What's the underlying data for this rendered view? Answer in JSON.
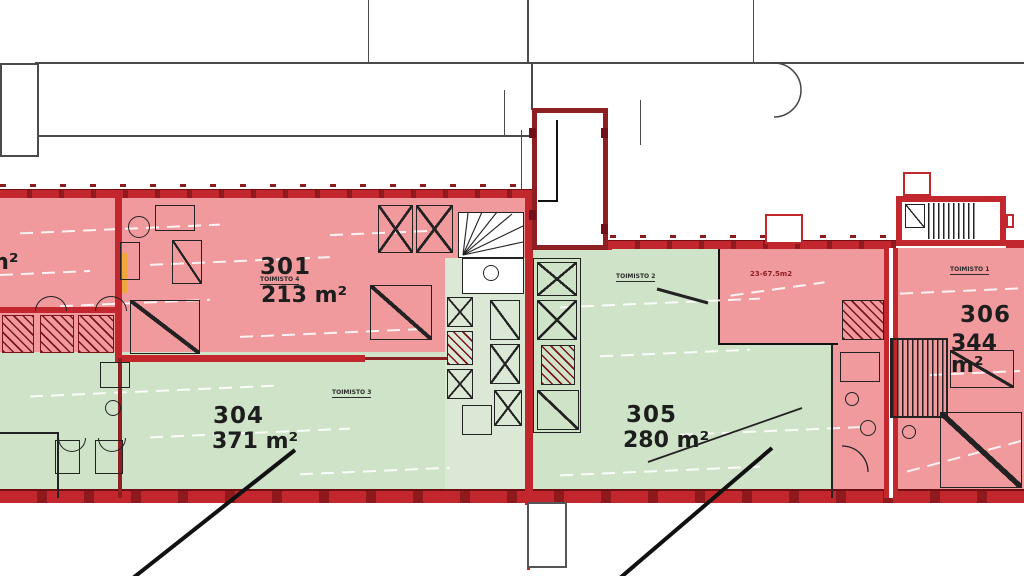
{
  "plan": {
    "kind": "architectural floor plan, office storey",
    "rooms": [
      {
        "number": "301",
        "area": "213 m²",
        "type_label": "TOIMISTO 4",
        "fill": "#f09a9d"
      },
      {
        "number": "304",
        "area": "371 m²",
        "type_label": "TOIMISTO 3",
        "fill": "#cfe3c8"
      },
      {
        "number": "305",
        "area": "280 m²",
        "type_label": "TOIMISTO 2",
        "fill": "#cfe3c8"
      },
      {
        "number": "306",
        "area": "344 m²",
        "type_label": "TOIMISTO 1",
        "fill": "#f09a9d"
      }
    ],
    "partial_labels": {
      "left_edge_area": "m²",
      "small_room_area": "23-67.5m2"
    },
    "palette": {
      "room_red": "#f09a9d",
      "room_green": "#cfe3c8",
      "core_green": "#dbe8d6",
      "wall_red": "#c1272d",
      "wall_dark_red": "#8e2024",
      "highlight_orange": "#efa63c",
      "outline_gray": "#4a4a4a",
      "line_black": "#222222"
    }
  }
}
